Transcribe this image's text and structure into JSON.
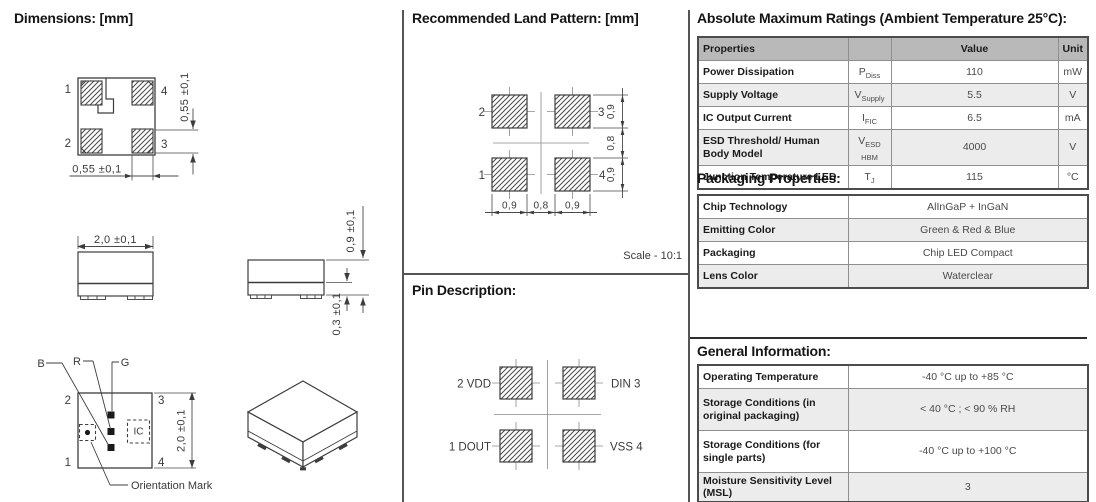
{
  "dimensions": {
    "title": "Dimensions: [mm]",
    "top_view": {
      "pin_tl": "1",
      "pin_tr": "4",
      "pin_bl": "2",
      "pin_br": "3",
      "dim_pad_height": "0,55 ±0,1",
      "dim_pad_width": "0,55 ±0,1"
    },
    "front_view": {
      "dim_width": "2,0 ±0,1"
    },
    "side_view": {
      "dim_height": "0,9 ±0,1",
      "dim_standoff": "0,3 ±0,1"
    },
    "internal_view": {
      "pin_tl": "2",
      "pin_tr": "3",
      "pin_bl": "1",
      "pin_br": "4",
      "label_blue": "B",
      "label_red": "R",
      "label_green": "G",
      "label_ic": "IC",
      "dim_height": "2,0 ±0,1",
      "orientation_mark_label": "Orientation Mark"
    }
  },
  "land_pattern": {
    "title": "Recommended Land Pattern: [mm]",
    "pad_tl": "2",
    "pad_tr": "3",
    "pad_bl": "1",
    "pad_br": "4",
    "dim_bottom_left": "0,9",
    "dim_bottom_center": "0,8",
    "dim_bottom_right": "0,9",
    "dim_right_top": "0,9",
    "dim_right_center": "0,8",
    "dim_right_bottom": "0,9",
    "scale_note": "Scale - 10:1"
  },
  "pin_description": {
    "title": "Pin Description:",
    "pin_tl": "2 VDD",
    "pin_tr": "DIN 3",
    "pin_bl": "1 DOUT",
    "pin_br": "VSS 4"
  },
  "absolute_maximum_ratings": {
    "title": "Absolute Maximum Ratings (Ambient Temperature 25°C):",
    "headers": {
      "property": "Properties",
      "symbol": "",
      "value": "Value",
      "unit": "Unit"
    },
    "rows": [
      {
        "property": "Power Dissipation",
        "symbol_base": "P",
        "symbol_sub": "Diss",
        "value": "110",
        "unit": "mW"
      },
      {
        "property": "Supply Voltage",
        "symbol_base": "V",
        "symbol_sub": "Supply",
        "value": "5.5",
        "unit": "V"
      },
      {
        "property": "IC Output Current",
        "symbol_base": "I",
        "symbol_sub": "FIC",
        "value": "6.5",
        "unit": "mA"
      },
      {
        "property": "ESD Threshold/ Human Body Model",
        "symbol_base": "V",
        "symbol_sub": "ESD HBM",
        "value": "4000",
        "unit": "V"
      },
      {
        "property": "Junction Temperature LED",
        "symbol_base": "T",
        "symbol_sub": "J",
        "value": "115",
        "unit": "°C"
      }
    ]
  },
  "packaging_properties": {
    "title": "Packaging Properties:",
    "rows": [
      {
        "property": "Chip Technology",
        "value": "AlInGaP + InGaN"
      },
      {
        "property": "Emitting Color",
        "value": "Green & Red & Blue"
      },
      {
        "property": "Packaging",
        "value": "Chip LED Compact"
      },
      {
        "property": "Lens Color",
        "value": "Waterclear"
      }
    ]
  },
  "general_information": {
    "title": "General Information:",
    "rows": [
      {
        "property": "Operating Temperature",
        "value": "-40 °C up to +85 °C"
      },
      {
        "property": "Storage Conditions (in original packaging)",
        "value": "< 40 °C ; < 90 % RH"
      },
      {
        "property": "Storage Conditions (for single parts)",
        "value": "-40 °C up to +100 °C"
      },
      {
        "property": "Moisture Sensitivity Level (MSL)",
        "value": "3"
      }
    ]
  },
  "colors": {
    "table_header_bg": "#b9b9b9",
    "row_shaded_bg": "#ececec",
    "line_color": "#3d3d3d"
  }
}
